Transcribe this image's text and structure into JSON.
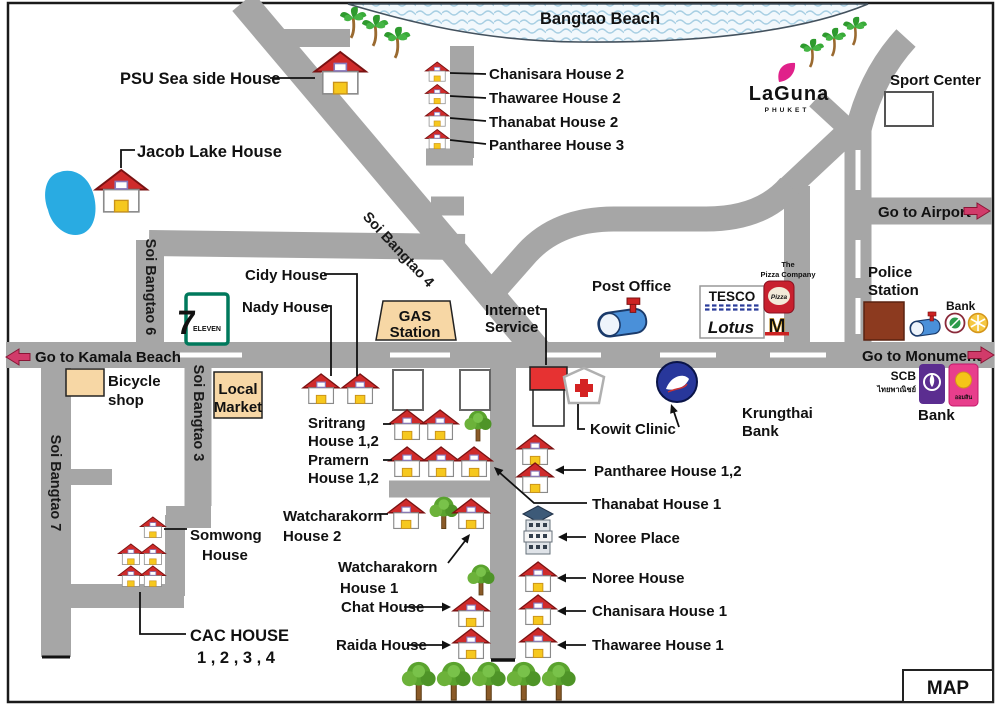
{
  "beach": {
    "label": "Bangtao Beach"
  },
  "roads": {
    "soi_bangtao_4": "Soi Bangtao 4",
    "soi_bangtao_6": "Soi Bangtao 6",
    "soi_bangtao_7": "Soi Bangtao 7",
    "soi_bangtao_3": "Soi Bangtao 3",
    "go_to_kamala_beach": "Go to Kamala Beach",
    "go_to_monument": "Go to Monument",
    "go_to_airport": "Go to Airport"
  },
  "landmarks": {
    "sport_center": "Sport Center",
    "police_station": {
      "line1": "Police",
      "line2": "Station"
    },
    "bank_northeast": "Bank",
    "post_office": "Post Office",
    "gas_station": {
      "line1": "GAS",
      "line2": "Station"
    },
    "internet_service": {
      "line1": "Internet",
      "line2": "Service"
    },
    "bicycle_shop": {
      "line1": "Bicycle",
      "line2": "shop"
    },
    "local_market": {
      "line1": "Local",
      "line2": "Market"
    },
    "kowit_clinic": "Kowit Clinic",
    "krungthai_bank": {
      "line1": "Krungthai",
      "line2": "Bank"
    },
    "scb": {
      "name": "SCB",
      "thai": "ไทยพาณิชย์"
    },
    "bank_southeast": "Bank",
    "pizza_company": {
      "line1": "The",
      "line2": "Pizza Company"
    },
    "tesco": {
      "line1": "TESCO",
      "line2": "Lotus"
    },
    "map_badge": "MAP"
  },
  "houses": {
    "psu_sea_side": "PSU Sea side House",
    "jacob_lake": "Jacob Lake House",
    "chanisara_2": "Chanisara House 2",
    "thawaree_2": "Thawaree House 2",
    "thanabat_2": "Thanabat House 2",
    "pantharee_3": "Pantharee House 3",
    "cidy": "Cidy House",
    "nady": "Nady House",
    "sritrang": {
      "line1": "Sritrang",
      "line2": "House 1,2"
    },
    "pramern": {
      "line1": "Pramern",
      "line2": "House 1,2"
    },
    "pantharee_12": "Pantharee House 1,2",
    "thanabat_1": "Thanabat House 1",
    "noree_place": "Noree Place",
    "noree_house": "Noree House",
    "chanisara_1": "Chanisara House 1",
    "thawaree_1": "Thawaree House 1",
    "watcharakorn_2": {
      "line1": "Watcharakorn",
      "line2": "House  2"
    },
    "watcharakorn_1": {
      "line1": "Watcharakorn",
      "line2": "House  1"
    },
    "chat": "Chat House",
    "raida": "Raida House",
    "somwong": {
      "line1": "Somwong",
      "line2": "House"
    },
    "cac": {
      "line1": "CAC HOUSE",
      "line2": "1 , 2 , 3 , 4"
    }
  },
  "logos": {
    "laguna": {
      "name": "LaGuna",
      "sub": "PHUKET"
    },
    "seven_eleven": {
      "seven": "7",
      "eleven": "ELEVEN"
    },
    "pizza_script": "Pizza",
    "mcdonalds": "M",
    "gsb_thai": "ออมสิน"
  },
  "colors": {
    "road": "#a6a6a6",
    "water_wave": "#a8cfe3",
    "roof_red": "#cf2b2b",
    "door_yellow": "#f6c81e",
    "arrow_pink": "#d13b6a",
    "laguna_teal": "#18a094",
    "tesco_red": "#cc2231",
    "lotus_green": "#1b7a3e",
    "scb_purple": "#5b2d90",
    "gsb_pink": "#e83e8c",
    "police_brown": "#8c3a1f",
    "box_tan": "#f7d7a5",
    "seven_green": "#00795c",
    "seven_orange": "#ee3124",
    "krungthai_blue": "#28379b",
    "lake_blue": "#29abe2"
  }
}
